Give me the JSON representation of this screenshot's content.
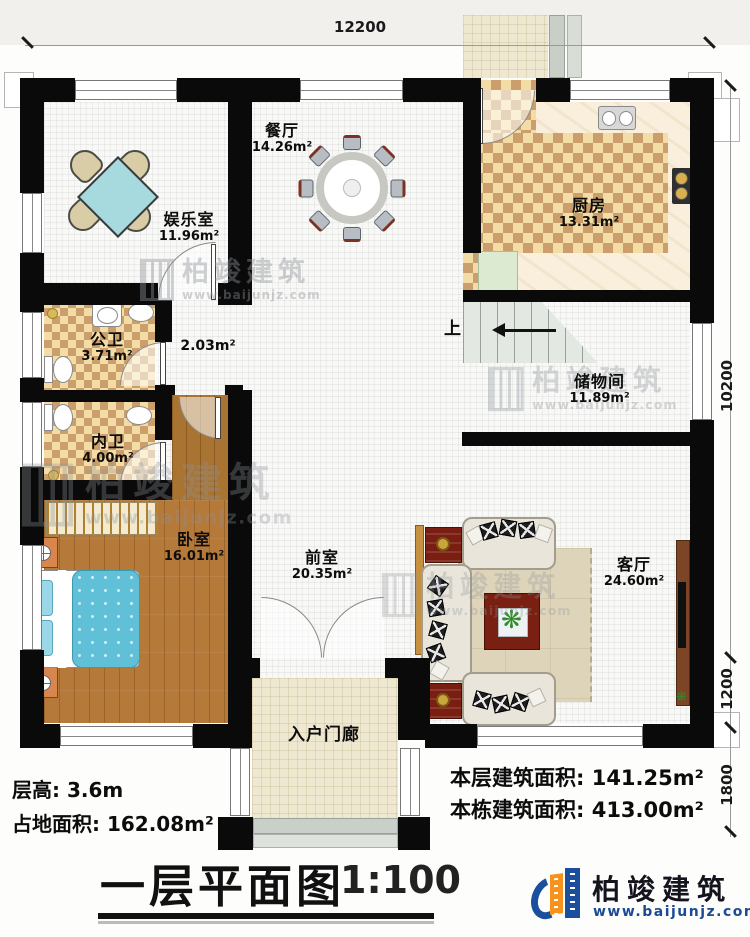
{
  "dimensions": {
    "top": "12200",
    "right_upper": "10200",
    "right_mid": "1200",
    "right_lower": "1800"
  },
  "rooms": {
    "entertainment": {
      "name": "娱乐室",
      "area": "11.96m²"
    },
    "dining": {
      "name": "餐厅",
      "area": "14.26m²"
    },
    "kitchen": {
      "name": "厨房",
      "area": "13.31m²"
    },
    "public_bath": {
      "name": "公卫",
      "area": "3.71m²"
    },
    "hallway": {
      "area": "2.03m²"
    },
    "private_bath": {
      "name": "内卫",
      "area": "4.00m²"
    },
    "bedroom": {
      "name": "卧室",
      "area": "16.01m²"
    },
    "front_room": {
      "name": "前室",
      "area": "20.35m²"
    },
    "storage": {
      "name": "储物间",
      "area": "11.89m²"
    },
    "living": {
      "name": "客厅",
      "area": "24.60m²"
    },
    "porch": {
      "name": "入户门廊"
    }
  },
  "stairs": {
    "up_label": "上"
  },
  "footer": {
    "floor_height": "层高: 3.6m",
    "land_area": "占地面积: 162.08m²",
    "floor_build_area": "本层建筑面积: 141.25m²",
    "total_build_area": "本栋建筑面积: 413.00m²",
    "title": "一层平面图",
    "scale": "1:100"
  },
  "brand": {
    "name": "柏竣建筑",
    "url": "www.baijunjz.com"
  },
  "watermark": {
    "name": "柏竣建筑",
    "url": "www.baijunjz.com"
  },
  "icons": {
    "plant": "❋"
  },
  "colors": {
    "wall": "#0a0a0a",
    "brand_blue": "#1b4f9e",
    "brand_orange": "#f6921e",
    "wood": "#b5793a",
    "checker_dark": "#cb9f6b",
    "checker_light": "#f4dca6",
    "bed_blue": "#5fc0d8"
  }
}
